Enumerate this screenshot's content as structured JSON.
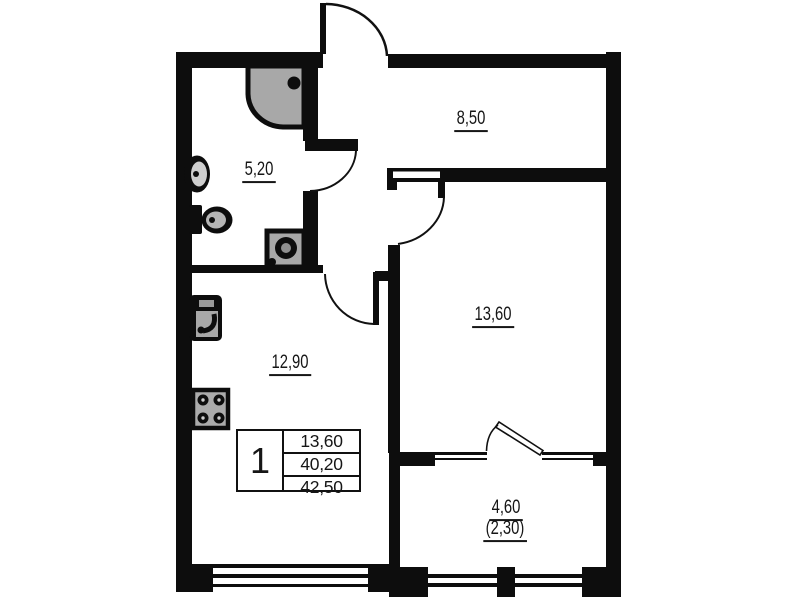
{
  "floorplan": {
    "background": "#ffffff",
    "wall_color": "#0d0d0d",
    "fixture_color": "#a8a8a8",
    "rooms": [
      {
        "name": "bathroom",
        "area": "5,20"
      },
      {
        "name": "hallway",
        "area": "8,50"
      },
      {
        "name": "living-room",
        "area": "13,60"
      },
      {
        "name": "kitchen-living",
        "area": "12,90"
      },
      {
        "name": "balcony",
        "area": "4,60",
        "area_reduced": "(2,30)"
      }
    ],
    "summary_table": {
      "rooms_count": "1",
      "row_living_area": "13,60",
      "row_area_no_balcony": "40,20",
      "row_total_area": "42,50"
    },
    "fixtures": [
      "shower",
      "washbasin",
      "toilet",
      "washing-machine",
      "kitchen-sink",
      "stove"
    ]
  }
}
